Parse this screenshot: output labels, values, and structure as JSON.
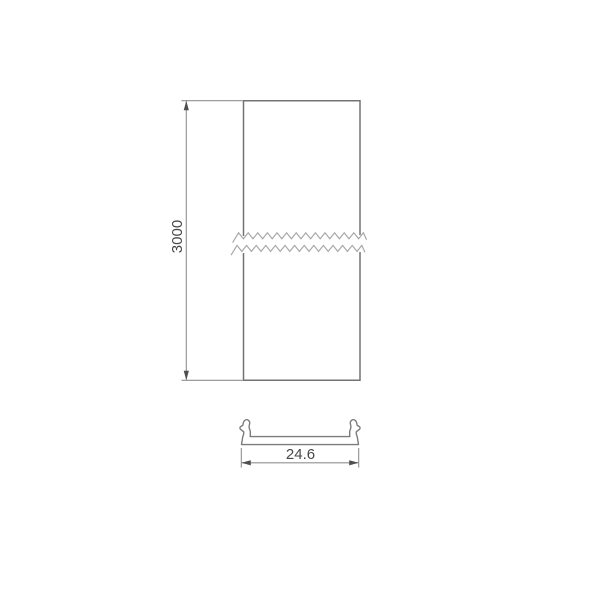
{
  "drawing": {
    "dimensions": {
      "length": "3000",
      "width": "24.6"
    },
    "colors": {
      "background": "#ffffff",
      "outline": "#737373",
      "section_outline": "#7c7c7c",
      "dimension": "#909090",
      "arrow": "#4f4f4f",
      "break_line": "#a8a8a8",
      "text": "#474747"
    }
  }
}
